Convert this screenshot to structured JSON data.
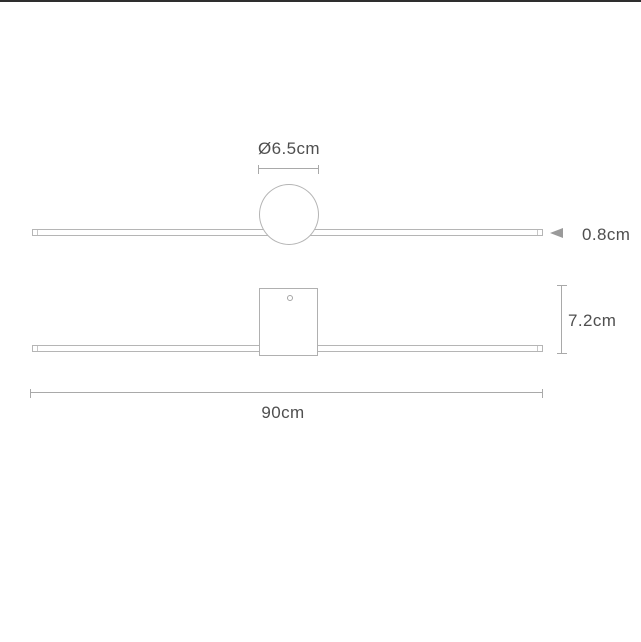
{
  "canvas": {
    "width": 641,
    "height": 642,
    "background": "#ffffff",
    "top_border_color": "#2e2e2e"
  },
  "colors": {
    "outline": "#b5b5b5",
    "dimension_line": "#a9a9a9",
    "text": "#4f4f4f",
    "arrow": "#9a9a9a"
  },
  "labels": {
    "plan_diameter": "Ø6.5cm",
    "plan_thickness": "0.8cm",
    "front_height": "7.2cm",
    "front_width": "90cm"
  }
}
